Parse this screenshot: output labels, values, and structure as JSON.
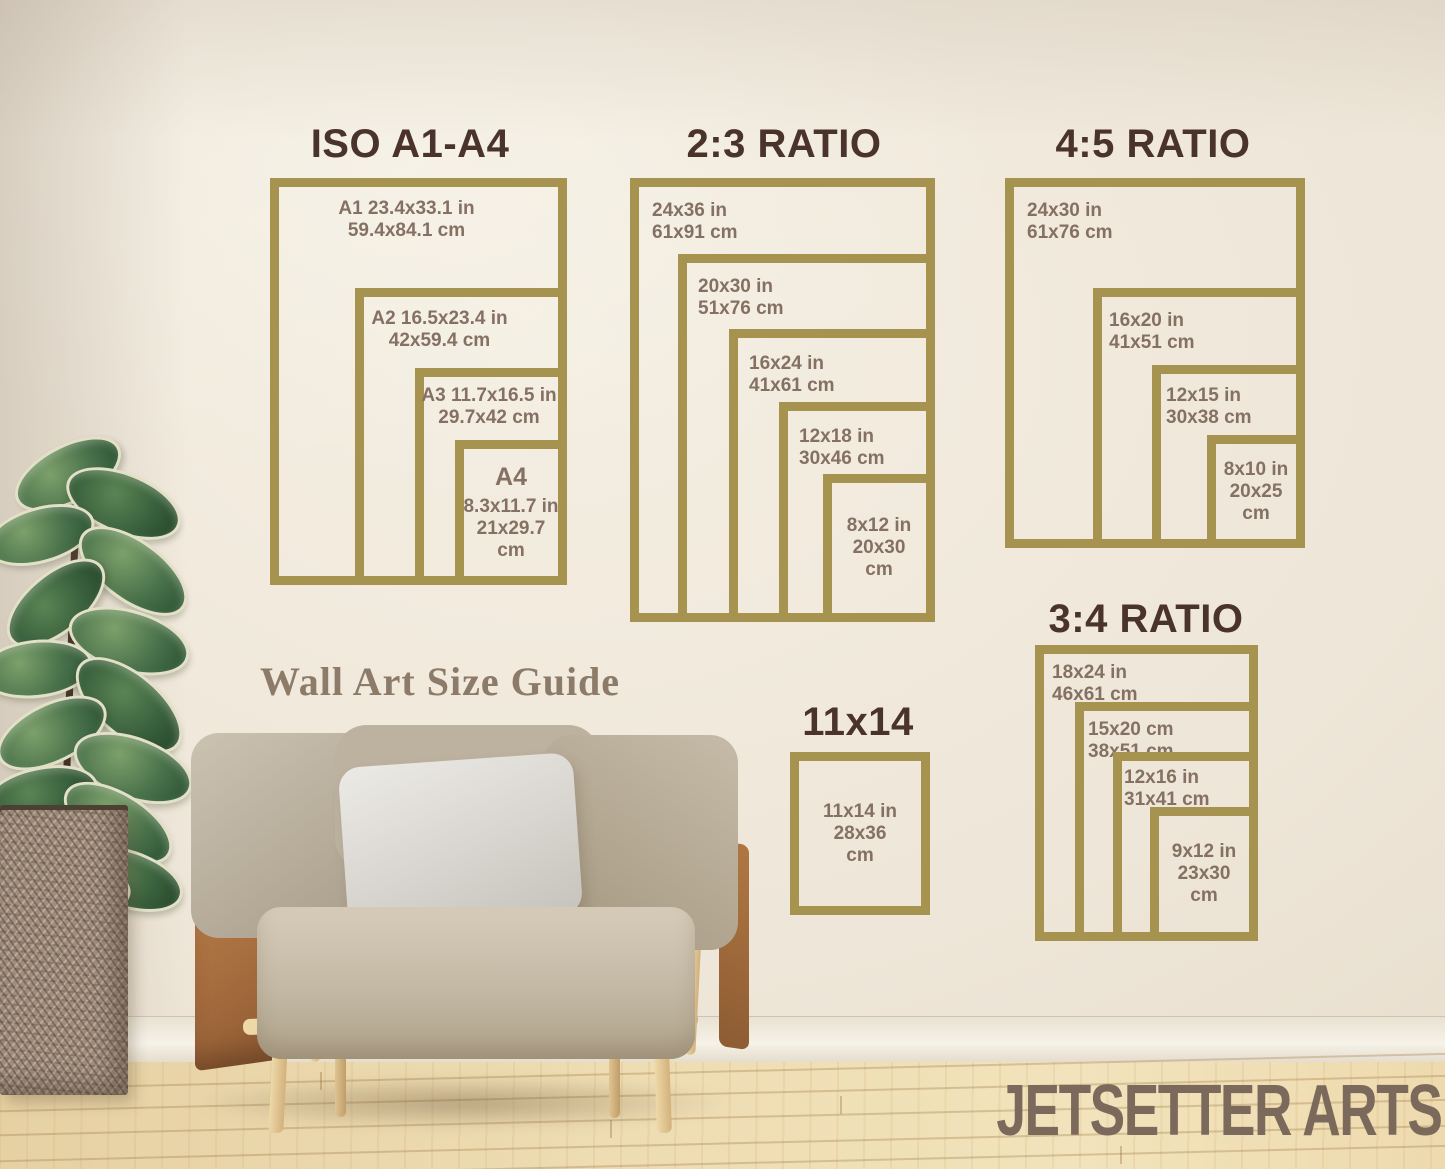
{
  "colors": {
    "frame_gold": "#a6934f",
    "title_brown": "#4a332a",
    "label_brown": "#857163",
    "caption_brown": "#8d7b6a",
    "watermark_brown": "#7b6a5c",
    "wall_cream": "#ece3d4",
    "floor_wood": "#ecd9ad"
  },
  "caption": "Wall Art Size Guide",
  "watermark": "JETSETTER ARTS",
  "panels": [
    {
      "id": "iso",
      "title": "ISO A1-A4",
      "frames": [
        {
          "lines": [
            "A1 23.4x33.1 in",
            "59.4x84.1 cm"
          ]
        },
        {
          "lines": [
            "A2 16.5x23.4 in",
            "42x59.4 cm"
          ]
        },
        {
          "lines": [
            "A3 11.7x16.5 in",
            "29.7x42 cm"
          ]
        },
        {
          "lines": [
            "A4",
            "8.3x11.7 in",
            "21x29.7",
            "cm"
          ]
        }
      ]
    },
    {
      "id": "r23",
      "title": "2:3 RATIO",
      "frames": [
        {
          "lines": [
            "24x36 in",
            "61x91 cm"
          ]
        },
        {
          "lines": [
            "20x30 in",
            "51x76 cm"
          ]
        },
        {
          "lines": [
            "16x24 in",
            "41x61 cm"
          ]
        },
        {
          "lines": [
            "12x18 in",
            "30x46 cm"
          ]
        },
        {
          "lines": [
            "8x12 in",
            "20x30",
            "cm"
          ]
        }
      ]
    },
    {
      "id": "r45",
      "title": "4:5 RATIO",
      "frames": [
        {
          "lines": [
            "24x30 in",
            "61x76 cm"
          ]
        },
        {
          "lines": [
            "16x20 in",
            "41x51 cm"
          ]
        },
        {
          "lines": [
            "12x15 in",
            "30x38 cm"
          ]
        },
        {
          "lines": [
            "8x10 in",
            "20x25",
            "cm"
          ]
        }
      ]
    },
    {
      "id": "r34",
      "title": "3:4 RATIO",
      "frames": [
        {
          "lines": [
            "18x24 in",
            "46x61 cm"
          ]
        },
        {
          "lines": [
            "15x20 cm",
            "38x51 cm"
          ]
        },
        {
          "lines": [
            "12x16 in",
            "31x41 cm"
          ]
        },
        {
          "lines": [
            "9x12 in",
            "23x30",
            "cm"
          ]
        }
      ]
    },
    {
      "id": "p1114",
      "title": "11x14",
      "frames": [
        {
          "lines": [
            "11x14 in",
            "28x36",
            "cm"
          ]
        }
      ]
    }
  ]
}
